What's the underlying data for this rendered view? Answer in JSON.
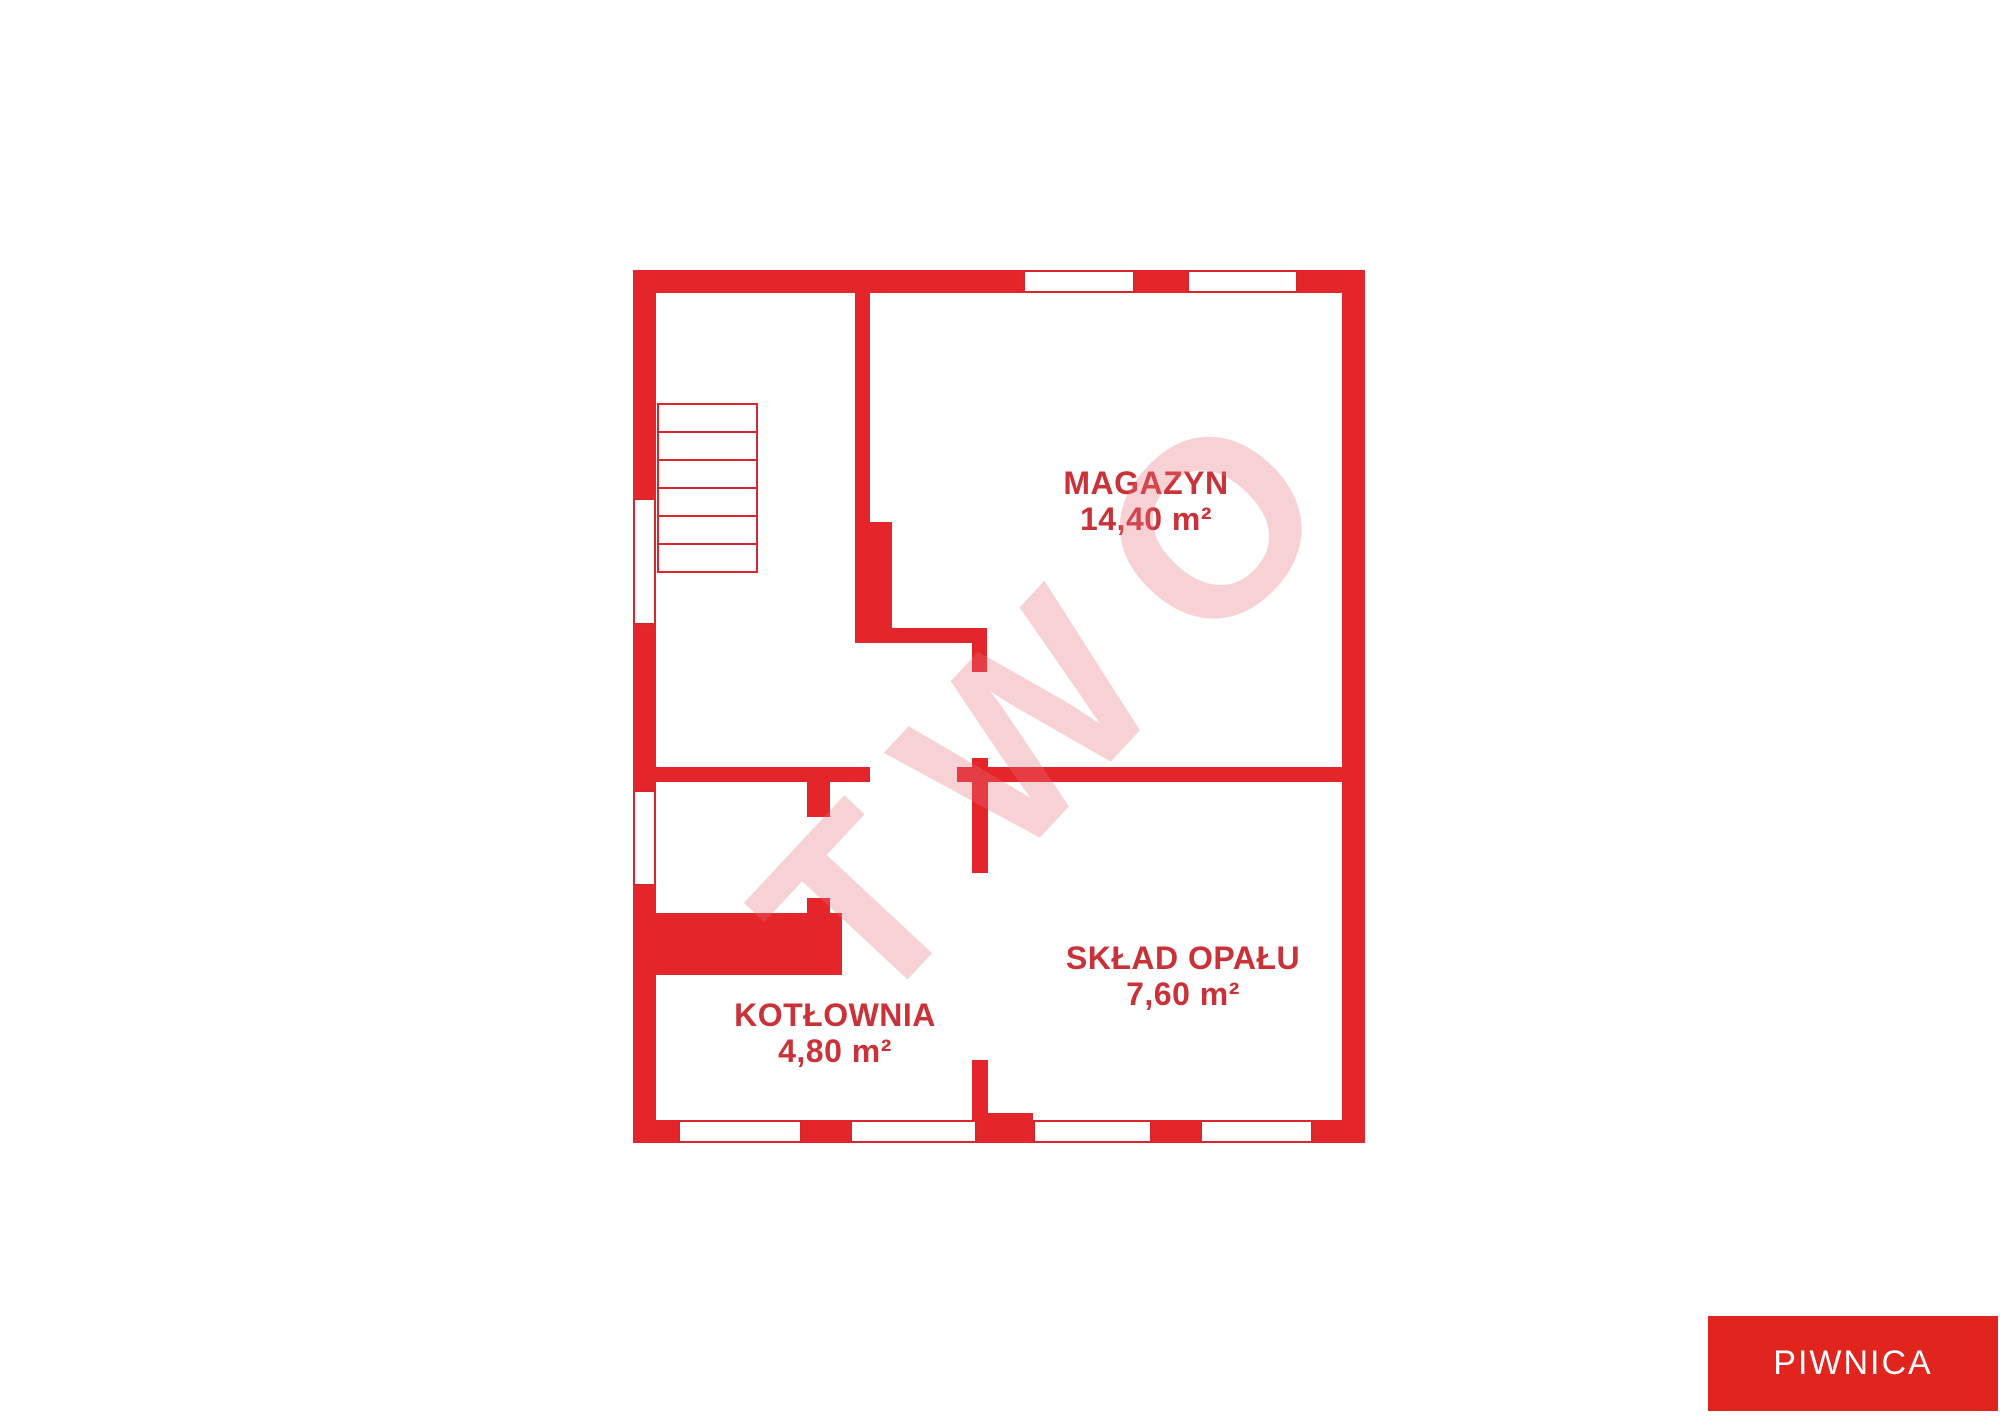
{
  "floor": {
    "label": "PIWNICA"
  },
  "rooms": [
    {
      "name": "MAGAZYN",
      "area": "14,40 m²"
    },
    {
      "name": "SKŁAD OPAŁU",
      "area": "7,60 m²"
    },
    {
      "name": "KOTŁOWNIA",
      "area": "4,80 m²"
    }
  ],
  "watermark": {
    "text": "TWO"
  },
  "colors": {
    "wall_red": "#e4252a",
    "window_outline_red": "#d8262c",
    "label_text_red": "#ca3138",
    "badge_red": "#e2241f",
    "badge_text": "#ffffff",
    "background": "#ffffff"
  }
}
